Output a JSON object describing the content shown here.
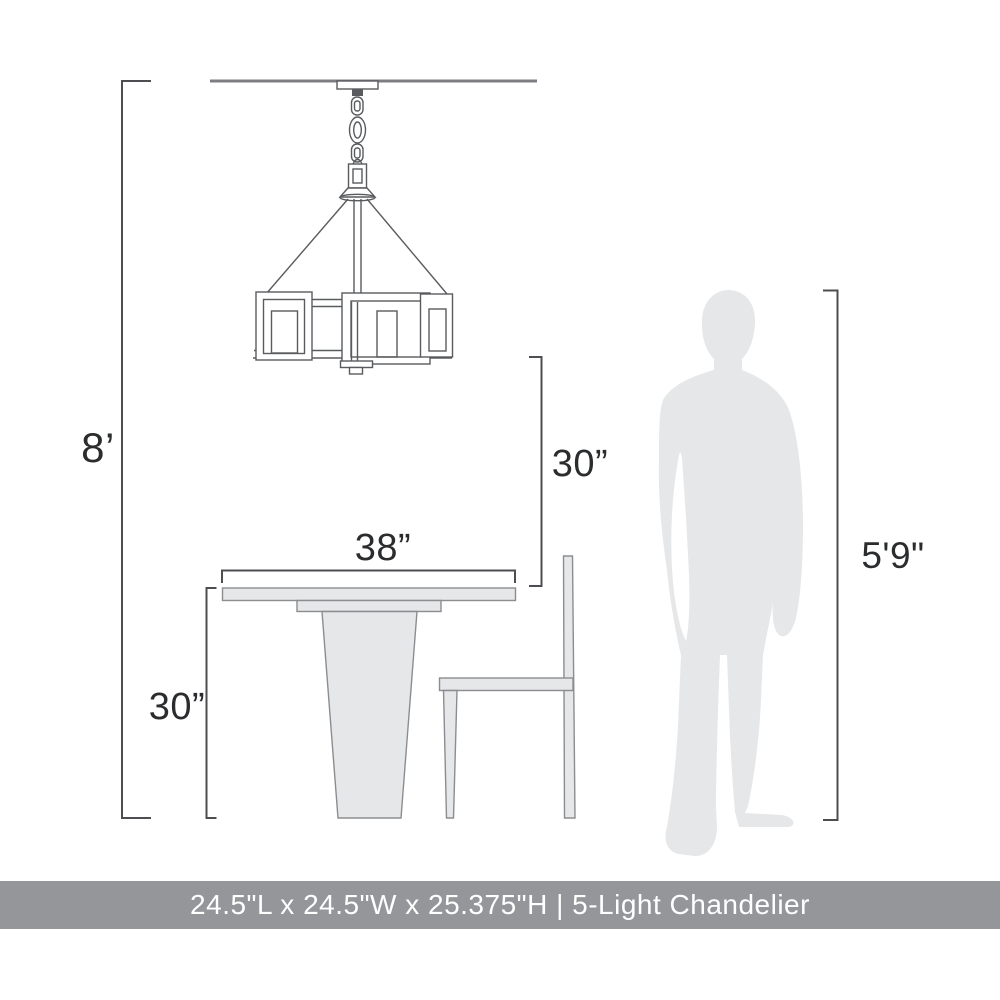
{
  "diagram": {
    "title": "5-Light Chandelier scale diagram",
    "dimensions": {
      "ceiling_height": "8’",
      "chandelier_to_table": "30”",
      "table_width": "38”",
      "table_height": "30”",
      "person_height": "5'9\""
    },
    "banner": {
      "text": "24.5\"L x 24.5\"W x 25.375\"H | 5-Light Chandelier"
    },
    "colors": {
      "banner_bg": "#95969a",
      "banner_text": "#ffffff",
      "label_text": "#2b2c2e",
      "dimension_line": "#4c4e51",
      "sketch_line": "#595b5e",
      "furniture_fill": "#e6e7e9",
      "silhouette_fill": "#e6e7e9",
      "background": "#ffffff"
    }
  }
}
